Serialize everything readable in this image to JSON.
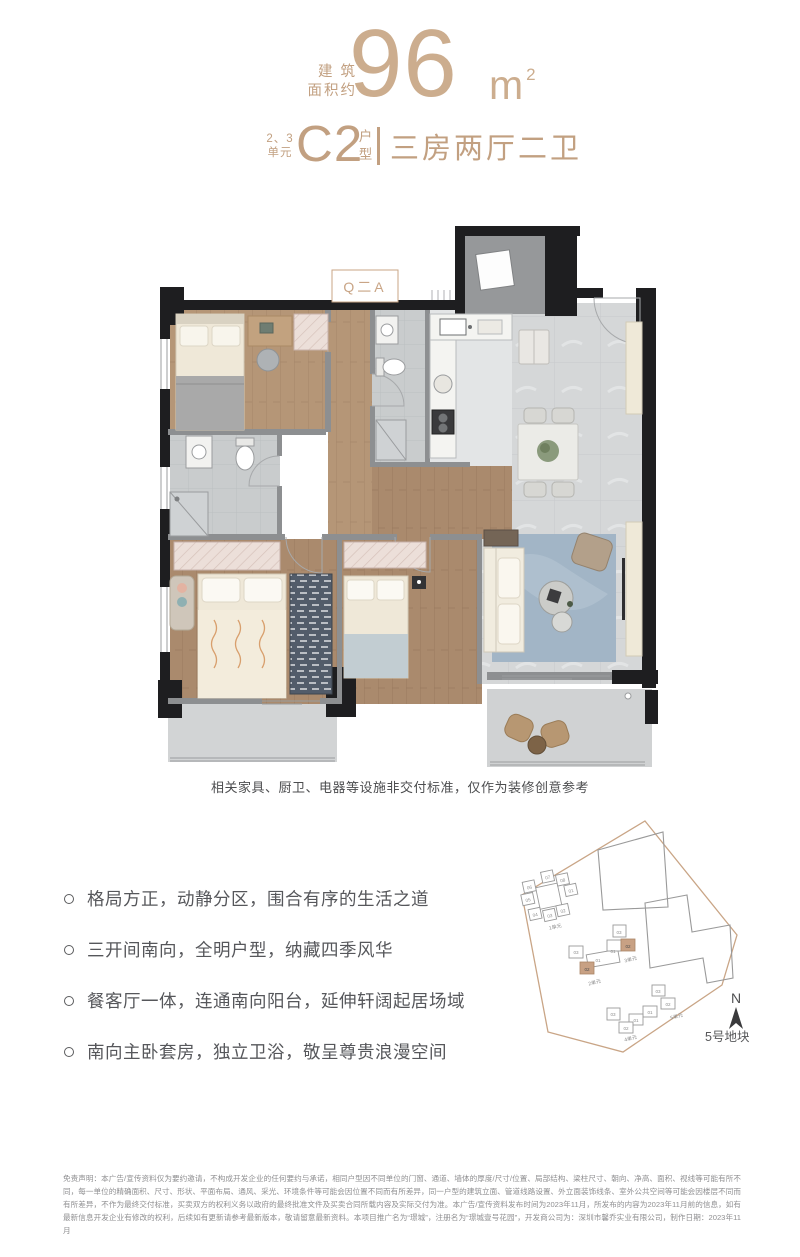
{
  "header": {
    "area_label": [
      "建 筑",
      "面积约"
    ],
    "area_value": "96",
    "area_unit": "m",
    "area_unit_sup": "2",
    "unit_group": [
      "2、3",
      "单元"
    ],
    "type_code": "C2",
    "type_word": [
      "户",
      "型"
    ],
    "layout_desc": "三房两厅二卫"
  },
  "floorplan": {
    "stamp_text": "Q二A",
    "caption": "相关家具、厨卫、电器等设施非交付标准，仅作为装修创意参考"
  },
  "features": [
    "格局方正，动静分区，围合有序的生活之道",
    "三开间南向，全明户型，纳藏四季风华",
    "餐客厅一体，连通南向阳台，延伸轩阔起居场域",
    "南向主卧套房，独立卫浴，敬呈尊贵浪漫空间"
  ],
  "siteplan": {
    "compass": "N",
    "plot_label": "5号地块",
    "clusters": [
      {
        "name": "1单元",
        "units": [
          "01",
          "02",
          "03",
          "04",
          "05",
          "06",
          "07",
          "08"
        ]
      },
      {
        "name": "2单元",
        "units": [
          "03",
          "01",
          "02"
        ]
      },
      {
        "name": "3单元",
        "units": [
          "03",
          "01",
          "02"
        ]
      },
      {
        "name": "4单元",
        "units": [
          "03",
          "02",
          "01"
        ]
      },
      {
        "name": "5单元",
        "units": [
          "01",
          "02",
          "03"
        ]
      }
    ]
  },
  "disclaimer": "免责声明：本广告/宣传资料仅为要约邀请，不构成开发企业的任何要约与承诺，相同户型因不同单位的门窗、通道、墙体的厚度/尺寸/位置、局部结构、梁柱尺寸、朝向、净高、面积、视线等可能有所不同，每一单位的精确面积、尺寸、形状、平面布局、通风、采光、环境条件等可能会因位置不同而有所差异，同一户型的建筑立面、管道线路设置、外立面装饰线条、室外公共空间等可能会因楼层不同而有所差异，不作为最终交付标准，买卖双方的权利义务以政府的最终批准文件及买卖合同所载内容及实际交付为准。本广告/宣传资料发布时间为2023年11月，所发布的内容为2023年11月前的信息，如有最新信息开发企业有修改的权利，后续如有更新请参考最新版本，敬请留意最新资料。本项目推广名为“璟城”，注册名为“璟城壹号花园”，开发商公司为：深圳市馨乔实业有限公司，制作日期：2023年11月",
  "colors": {
    "accent": "#c2a081",
    "text": "#56575b",
    "muted": "#8f8f91"
  }
}
